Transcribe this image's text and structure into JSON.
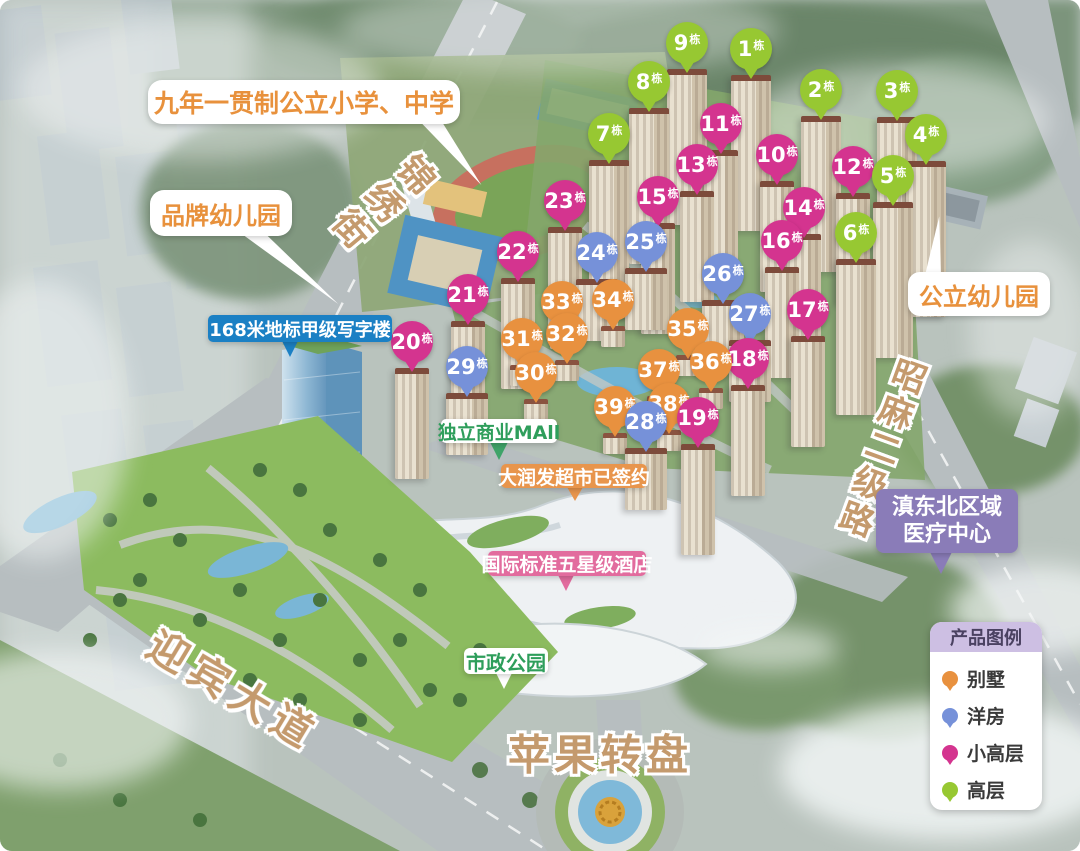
{
  "callouts": {
    "school": {
      "text": "九年一贯制公立小学、中学"
    },
    "brand_kindergarten": {
      "text": "品牌幼儿园"
    },
    "office_tower": {
      "text": "168米地标甲级写字楼",
      "bg": "#1B80C4"
    },
    "mall": {
      "text": "独立商业MAll"
    },
    "supermarket": {
      "text": "大润发超市已签约",
      "bg": "#E8954C"
    },
    "hotel": {
      "text": "国际标准五星级酒店",
      "bg": "#E26C9E"
    },
    "civic_park": {
      "text": "市政公园"
    },
    "public_kindergarten": {
      "text": "公立幼儿园"
    },
    "medical": {
      "line1": "滇东北区域",
      "line2": "医疗中心",
      "bg": "#8A7CB8"
    }
  },
  "road_labels": {
    "jinxiu_street": "锦绣街",
    "yingbin_avenue": "迎宾大道",
    "zhaoma_road": "昭麻二级路",
    "apple_roundabout": "苹果转盘"
  },
  "legend": {
    "title": "产品图例",
    "items": [
      {
        "label": "别墅",
        "type": "bieshu",
        "color": "#E8913F"
      },
      {
        "label": "洋房",
        "type": "yangfang",
        "color": "#7691D9"
      },
      {
        "label": "小高层",
        "type": "xiaogaoceng",
        "color": "#D4348F"
      },
      {
        "label": "高层",
        "type": "gaoceng",
        "color": "#97C832"
      }
    ]
  },
  "building_suffix": "栋",
  "buildings": [
    {
      "num": "1",
      "type": "gaoceng",
      "x": 751,
      "y": 49
    },
    {
      "num": "2",
      "type": "gaoceng",
      "x": 821,
      "y": 90
    },
    {
      "num": "3",
      "type": "gaoceng",
      "x": 897,
      "y": 91
    },
    {
      "num": "4",
      "type": "gaoceng",
      "x": 926,
      "y": 135
    },
    {
      "num": "5",
      "type": "gaoceng",
      "x": 893,
      "y": 176
    },
    {
      "num": "6",
      "type": "gaoceng",
      "x": 856,
      "y": 233
    },
    {
      "num": "7",
      "type": "gaoceng",
      "x": 609,
      "y": 134
    },
    {
      "num": "8",
      "type": "gaoceng",
      "x": 649,
      "y": 82
    },
    {
      "num": "9",
      "type": "gaoceng",
      "x": 687,
      "y": 43
    },
    {
      "num": "10",
      "type": "xiaogaoceng",
      "x": 777,
      "y": 155
    },
    {
      "num": "11",
      "type": "xiaogaoceng",
      "x": 721,
      "y": 124
    },
    {
      "num": "12",
      "type": "xiaogaoceng",
      "x": 853,
      "y": 167
    },
    {
      "num": "13",
      "type": "xiaogaoceng",
      "x": 697,
      "y": 165
    },
    {
      "num": "14",
      "type": "xiaogaoceng",
      "x": 804,
      "y": 208
    },
    {
      "num": "15",
      "type": "xiaogaoceng",
      "x": 658,
      "y": 197
    },
    {
      "num": "16",
      "type": "xiaogaoceng",
      "x": 782,
      "y": 241
    },
    {
      "num": "17",
      "type": "xiaogaoceng",
      "x": 808,
      "y": 310
    },
    {
      "num": "18",
      "type": "xiaogaoceng",
      "x": 748,
      "y": 359
    },
    {
      "num": "19",
      "type": "xiaogaoceng",
      "x": 698,
      "y": 418
    },
    {
      "num": "20",
      "type": "xiaogaoceng",
      "x": 412,
      "y": 342
    },
    {
      "num": "21",
      "type": "xiaogaoceng",
      "x": 468,
      "y": 295
    },
    {
      "num": "22",
      "type": "xiaogaoceng",
      "x": 518,
      "y": 252
    },
    {
      "num": "23",
      "type": "xiaogaoceng",
      "x": 565,
      "y": 201
    },
    {
      "num": "24",
      "type": "yangfang",
      "x": 597,
      "y": 253
    },
    {
      "num": "25",
      "type": "yangfang",
      "x": 646,
      "y": 242
    },
    {
      "num": "26",
      "type": "yangfang",
      "x": 723,
      "y": 274
    },
    {
      "num": "27",
      "type": "yangfang",
      "x": 750,
      "y": 314
    },
    {
      "num": "28",
      "type": "yangfang",
      "x": 646,
      "y": 422
    },
    {
      "num": "29",
      "type": "yangfang",
      "x": 467,
      "y": 367
    },
    {
      "num": "30",
      "type": "bieshu",
      "x": 536,
      "y": 373
    },
    {
      "num": "31",
      "type": "bieshu",
      "x": 522,
      "y": 339
    },
    {
      "num": "32",
      "type": "bieshu",
      "x": 567,
      "y": 334
    },
    {
      "num": "33",
      "type": "bieshu",
      "x": 562,
      "y": 302
    },
    {
      "num": "34",
      "type": "bieshu",
      "x": 613,
      "y": 300
    },
    {
      "num": "35",
      "type": "bieshu",
      "x": 688,
      "y": 329
    },
    {
      "num": "36",
      "type": "bieshu",
      "x": 711,
      "y": 362
    },
    {
      "num": "37",
      "type": "bieshu",
      "x": 659,
      "y": 370
    },
    {
      "num": "38",
      "type": "bieshu",
      "x": 669,
      "y": 404
    },
    {
      "num": "39",
      "type": "bieshu",
      "x": 615,
      "y": 407
    }
  ]
}
